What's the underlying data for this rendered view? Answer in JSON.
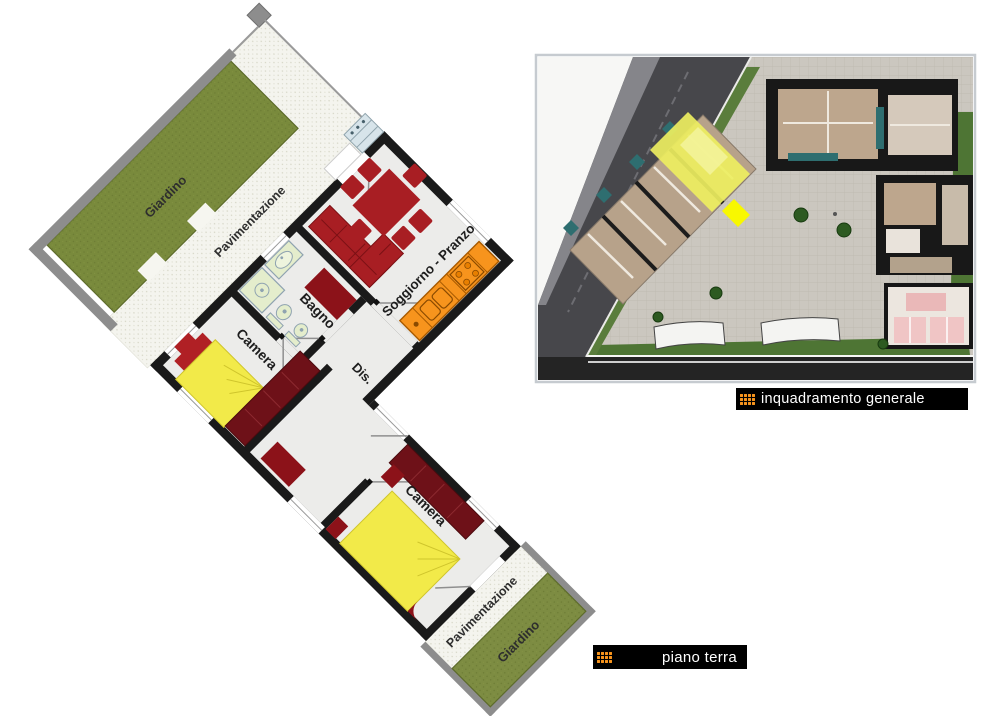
{
  "plan": {
    "labels": {
      "garden_top": "Giardino",
      "paving_top": "Pavimentazione",
      "living": "Soggiorno - Pranzo",
      "bath": "Bagno",
      "bedroom1": "Camera",
      "hall": "Dis.",
      "bedroom2": "Camera",
      "paving_bottom": "Pavimentazione",
      "garden_bottom": "Giardino"
    }
  },
  "captions": {
    "inset": "inquadramento generale",
    "floor": "piano terra"
  },
  "colors": {
    "wall": "#1a1a1a",
    "garden_green": "#798a3c",
    "boundary_gray": "#8d8d8d",
    "furniture_red": "#a81e23",
    "wardrobe_maroon": "#6e1118",
    "bed_yellow": "#f2ea49",
    "kitchen_orange": "#f7941d",
    "fixture_green": "#e4edcc",
    "caption_bg": "#000000",
    "caption_text": "#ffffff",
    "icon_orange": "#f7941d"
  }
}
